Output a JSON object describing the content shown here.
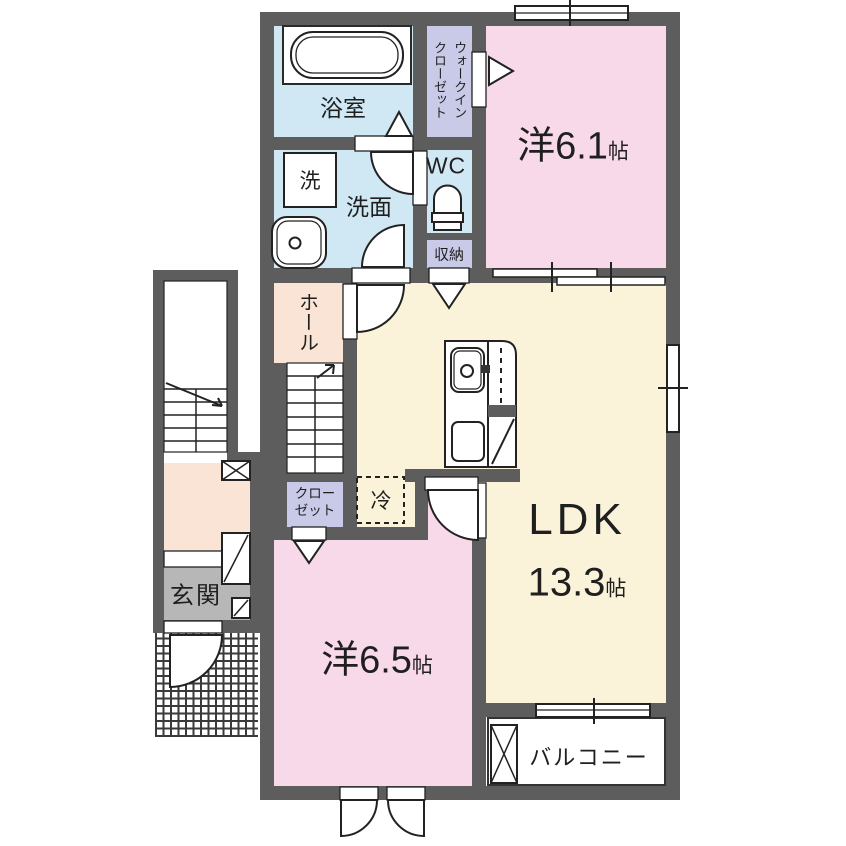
{
  "colors": {
    "wall": "#5d5d5d",
    "water_blue": "#cfe8f4",
    "closet_lavender": "#c9c9e8",
    "room_pink": "#f8d9e9",
    "ldk_cream": "#faf3da",
    "hall_peach": "#fae4d6",
    "entrance_gray": "#b7b7b7",
    "line": "#1f1f1f"
  },
  "labels": {
    "bathroom": "浴室",
    "washer": "洗",
    "washroom": "洗面",
    "wc": "WC",
    "wic_line1": "ウォークイン",
    "wic_line2": "クローゼット",
    "storage": "収納",
    "western_room_1": "洋6.1",
    "western_room_1_unit": "帖",
    "hall": "ホール",
    "closet_line1": "クロー",
    "closet_line2": "ゼット",
    "refrigerator": "冷",
    "ldk": "LDK",
    "ldk_size": "13.3",
    "ldk_unit": "帖",
    "western_room_2": "洋6.5",
    "western_room_2_unit": "帖",
    "balcony": "バルコニー",
    "entrance": "玄関"
  }
}
